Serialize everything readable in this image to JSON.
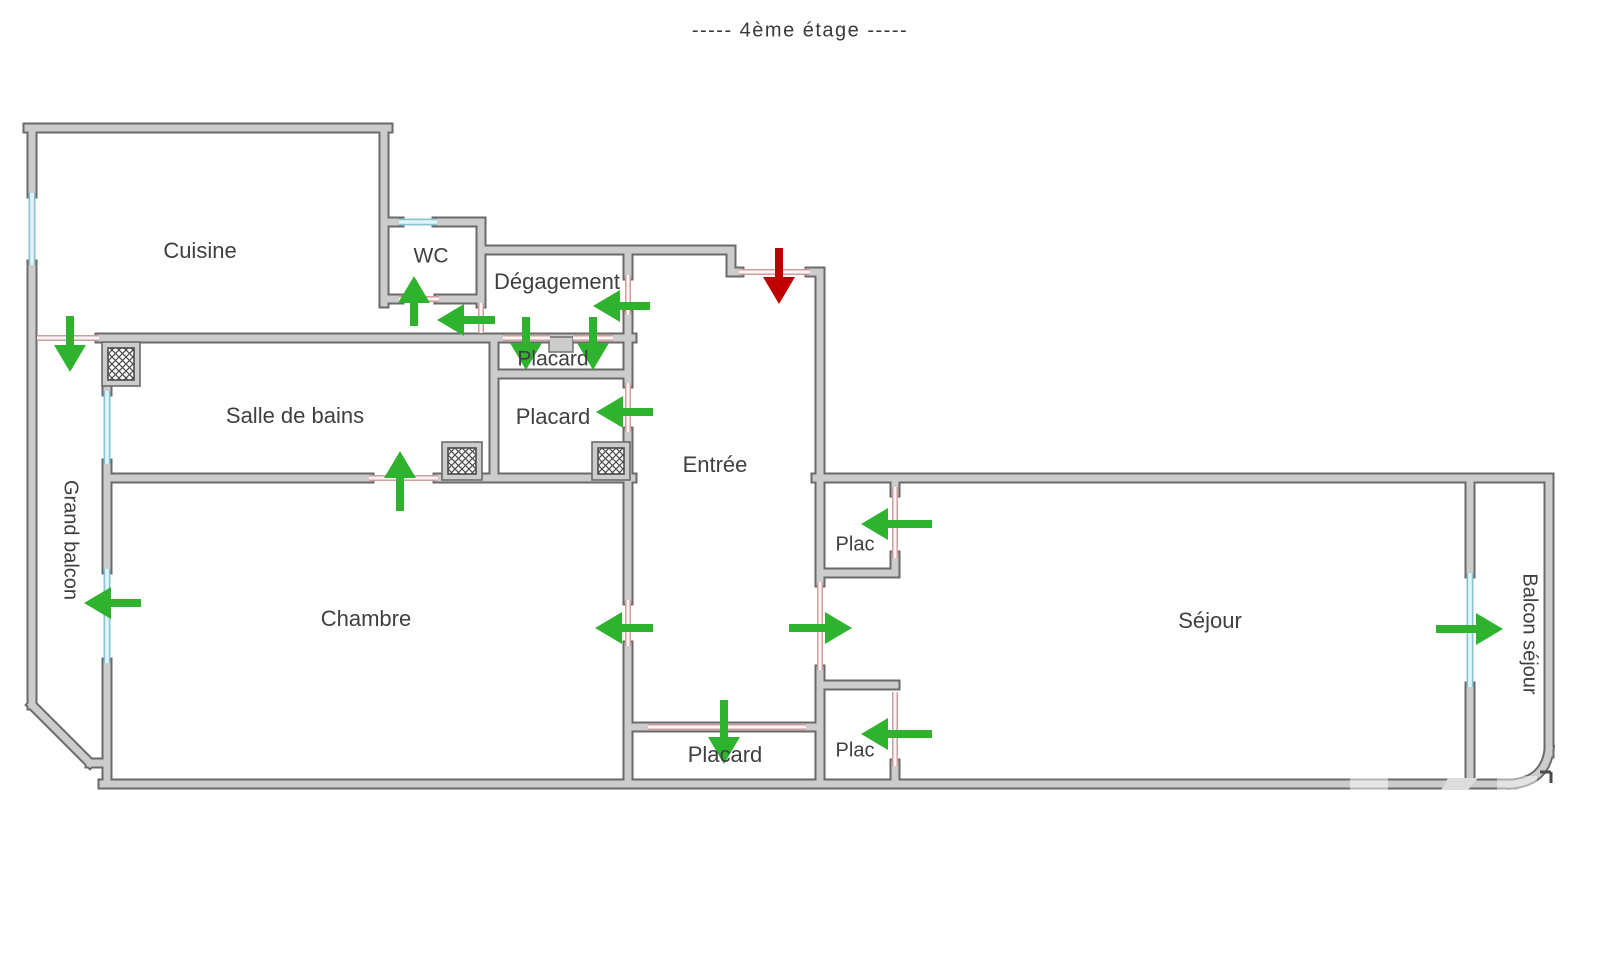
{
  "title": "-----  4ème étage  -----",
  "colors": {
    "arrow_green": "#2fb32f",
    "arrow_red": "#c00000",
    "label": "#3f3f3f",
    "wall_fill": "#cccccc",
    "wall_edge": "#6a6a6a",
    "window_fill": "#e2f6fa",
    "window_edge": "#8ac4d2",
    "door_line": "#cf9f9f",
    "door_fill": "#fdf5f5",
    "hatch": "#4a4a4a"
  },
  "rooms": [
    {
      "id": "cuisine",
      "label": "Cuisine",
      "x": 200,
      "y": 252,
      "rotate": 0,
      "size": 22
    },
    {
      "id": "wc",
      "label": "WC",
      "x": 431,
      "y": 257,
      "rotate": 0,
      "size": 21
    },
    {
      "id": "degagement",
      "label": "Dégagement",
      "x": 557,
      "y": 283,
      "rotate": 0,
      "size": 22
    },
    {
      "id": "placard-haut",
      "label": "Placard",
      "x": 553,
      "y": 360,
      "rotate": 0,
      "size": 21
    },
    {
      "id": "placard-milieu",
      "label": "Placard",
      "x": 553,
      "y": 418,
      "rotate": 0,
      "size": 22
    },
    {
      "id": "salle-de-bains",
      "label": "Salle de bains",
      "x": 295,
      "y": 417,
      "rotate": 0,
      "size": 22
    },
    {
      "id": "entree",
      "label": "Entrée",
      "x": 715,
      "y": 466,
      "rotate": 0,
      "size": 22
    },
    {
      "id": "plac-haut",
      "label": "Plac",
      "x": 855,
      "y": 545,
      "rotate": 0,
      "size": 20
    },
    {
      "id": "chambre",
      "label": "Chambre",
      "x": 366,
      "y": 620,
      "rotate": 0,
      "size": 22
    },
    {
      "id": "sejour",
      "label": "Séjour",
      "x": 1210,
      "y": 622,
      "rotate": 0,
      "size": 22
    },
    {
      "id": "plac-bas",
      "label": "Plac",
      "x": 855,
      "y": 751,
      "rotate": 0,
      "size": 20
    },
    {
      "id": "placard-bas",
      "label": "Placard",
      "x": 725,
      "y": 756,
      "rotate": 0,
      "size": 22
    },
    {
      "id": "grand-balcon",
      "label": "Grand balcon",
      "x": 70,
      "y": 540,
      "rotate": 90,
      "size": 20
    },
    {
      "id": "balcon-sejour",
      "label": "Balcon séjour",
      "x": 1529,
      "y": 634,
      "rotate": 90,
      "size": 20
    }
  ],
  "arrows": [
    {
      "id": "door-grand-balcon-cuisine",
      "dir": "down",
      "x": 70,
      "y": 372,
      "len": 56,
      "color": "green"
    },
    {
      "id": "door-wc",
      "dir": "up",
      "x": 414,
      "y": 276,
      "len": 50,
      "color": "green"
    },
    {
      "id": "door-cuisine-degagement",
      "dir": "left",
      "x": 437,
      "y": 320,
      "len": 58,
      "color": "green"
    },
    {
      "id": "door-entree-degagement",
      "dir": "left",
      "x": 593,
      "y": 306,
      "len": 57,
      "color": "green"
    },
    {
      "id": "door-placard-haut-1",
      "dir": "down",
      "x": 526,
      "y": 370,
      "len": 53,
      "color": "green"
    },
    {
      "id": "door-placard-haut-2",
      "dir": "down",
      "x": 593,
      "y": 370,
      "len": 53,
      "color": "green"
    },
    {
      "id": "door-placard-milieu",
      "dir": "left",
      "x": 596,
      "y": 412,
      "len": 57,
      "color": "green"
    },
    {
      "id": "door-salle-de-bains",
      "dir": "up",
      "x": 400,
      "y": 451,
      "len": 60,
      "color": "green"
    },
    {
      "id": "door-grand-balcon-chambre",
      "dir": "left",
      "x": 84,
      "y": 603,
      "len": 57,
      "color": "green"
    },
    {
      "id": "door-entree-chambre",
      "dir": "left",
      "x": 595,
      "y": 628,
      "len": 58,
      "color": "green"
    },
    {
      "id": "door-entree-sejour",
      "dir": "right",
      "x": 852,
      "y": 628,
      "len": 63,
      "color": "green"
    },
    {
      "id": "door-plac-haut",
      "dir": "left",
      "x": 861,
      "y": 524,
      "len": 71,
      "color": "green"
    },
    {
      "id": "door-plac-bas",
      "dir": "left",
      "x": 861,
      "y": 734,
      "len": 71,
      "color": "green"
    },
    {
      "id": "door-placard-bas",
      "dir": "down",
      "x": 724,
      "y": 764,
      "len": 64,
      "color": "green"
    },
    {
      "id": "door-balcon-sejour",
      "dir": "right",
      "x": 1503,
      "y": 629,
      "len": 67,
      "color": "green"
    },
    {
      "id": "entry-door",
      "dir": "down",
      "x": 779,
      "y": 304,
      "len": 56,
      "color": "red"
    }
  ]
}
